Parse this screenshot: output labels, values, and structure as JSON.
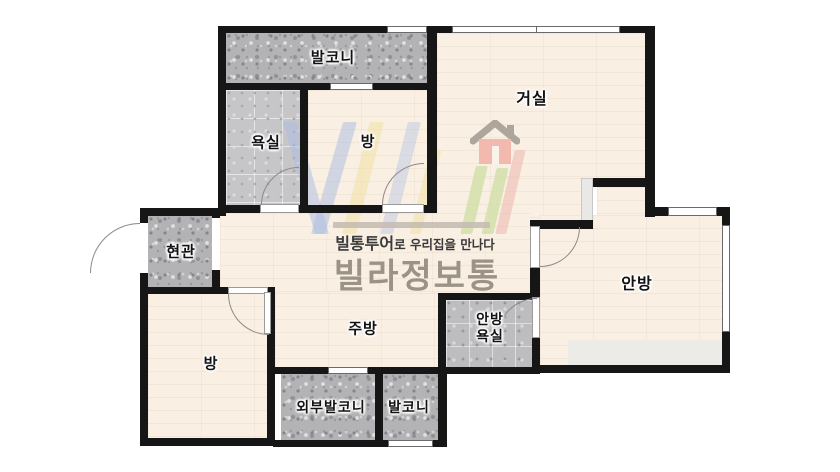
{
  "plan": {
    "type": "apartment-floor-plan",
    "wall_color": "#161616",
    "floor_color": "#f9efe3",
    "balcony_texture_color": "#b3b3b6",
    "bathroom_texture_color": "#c6c6c9",
    "outside_color": "#ffffff"
  },
  "rooms": [
    {
      "id": "balcony-top",
      "label": "발코니"
    },
    {
      "id": "bathroom",
      "label": "욕실"
    },
    {
      "id": "room-top",
      "label": "방"
    },
    {
      "id": "living-room",
      "label": "거실"
    },
    {
      "id": "entrance",
      "label": "현관"
    },
    {
      "id": "master-bedroom",
      "label": "안방"
    },
    {
      "id": "kitchen",
      "label": "주방"
    },
    {
      "id": "master-bathroom",
      "label_line1": "안방",
      "label_line2": "욕실"
    },
    {
      "id": "room-bottom",
      "label": "방"
    },
    {
      "id": "outer-balcony",
      "label": "외부발코니"
    },
    {
      "id": "balcony-bottom",
      "label": "발코니"
    }
  ],
  "watermark": {
    "tagline_bold": "빌통투어",
    "tagline_rest": "로 우리집을 만나다",
    "title": "빌라정보통",
    "title_color": "#9c9387",
    "house_body_color": "#f2b4aa",
    "house_roof_color": "#a59f96",
    "letter_colors": {
      "blue": "#a9bce2",
      "yellow": "#f1df9e",
      "green": "#cedda2",
      "red": "#edb2a7"
    }
  }
}
